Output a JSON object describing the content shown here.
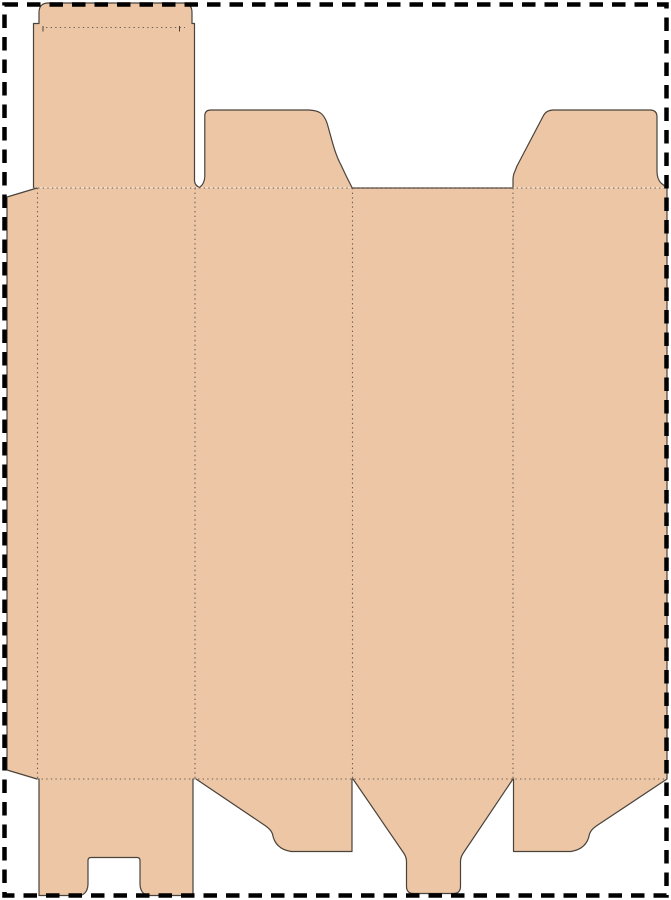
{
  "document": {
    "kind": "packaging dieline template",
    "description": "Flat die-cut layout of a tuck-top carton box drawn on a white page with a black dashed cut border"
  },
  "canvas": {
    "width": 671,
    "height": 900,
    "background": "#ffffff"
  },
  "colors": {
    "board": "#ecc6a5",
    "cut": "#4a433c",
    "dots": "#6e6156",
    "border": "#000000",
    "page_bg": "#ffffff"
  },
  "parts": [
    {
      "id": "page-border",
      "label": "dashed page cut border"
    },
    {
      "id": "glue-flap",
      "label": "left glue flap with beveled ends"
    },
    {
      "id": "main-body",
      "label": "four body panels in a row"
    },
    {
      "id": "lid-tuck-flap",
      "label": "top lid panel with rounded tuck flap over panel 1"
    },
    {
      "id": "dust-flap-top-left",
      "label": "top dust flap over panel 2"
    },
    {
      "id": "dust-flap-top-right",
      "label": "top dust flap over panel 4"
    },
    {
      "id": "bottom-slotted-flap",
      "label": "bottom flap with center slot under panel 1"
    },
    {
      "id": "bottom-dust-flap-left",
      "label": "slanted bottom dust flap under panel 2"
    },
    {
      "id": "bottom-tongue-flap",
      "label": "tapered bottom tuck tongue under panel 3"
    },
    {
      "id": "bottom-dust-flap-right",
      "label": "slanted bottom dust flap under panel 4"
    },
    {
      "id": "fold-lines",
      "label": "dotted crease fold lines"
    }
  ]
}
